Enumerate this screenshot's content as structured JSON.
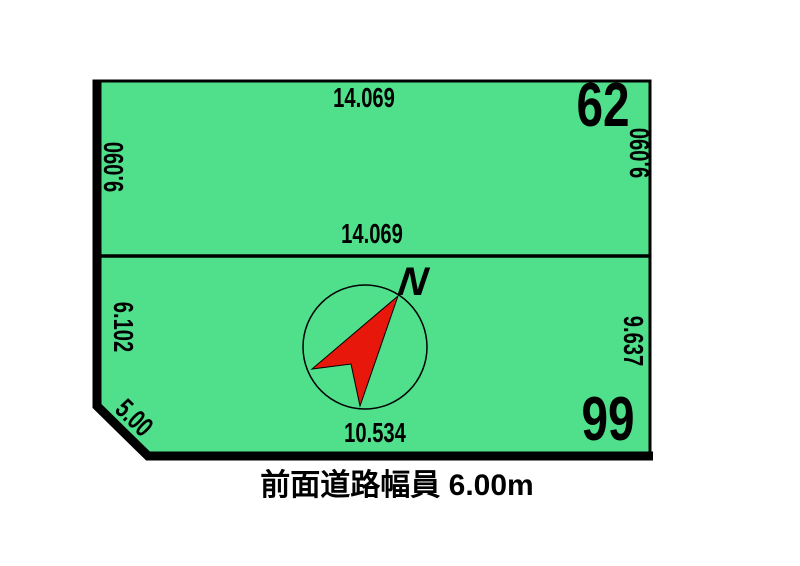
{
  "colors": {
    "land_fill": "#50E08B",
    "compass_needle": "#E8170C",
    "line": "#000000"
  },
  "lot_62": {
    "number": "62",
    "dim_top": "14.069",
    "dim_bottom": "14.069",
    "dim_left": "9.090",
    "dim_right": "9.090"
  },
  "lot_99": {
    "number": "99",
    "dim_left": "6.102",
    "dim_right": "9.637",
    "dim_bottom": "10.534",
    "dim_corner_cut": "5.00"
  },
  "compass": {
    "label": "N"
  },
  "caption": {
    "text": "前面道路幅員 6.00m"
  }
}
